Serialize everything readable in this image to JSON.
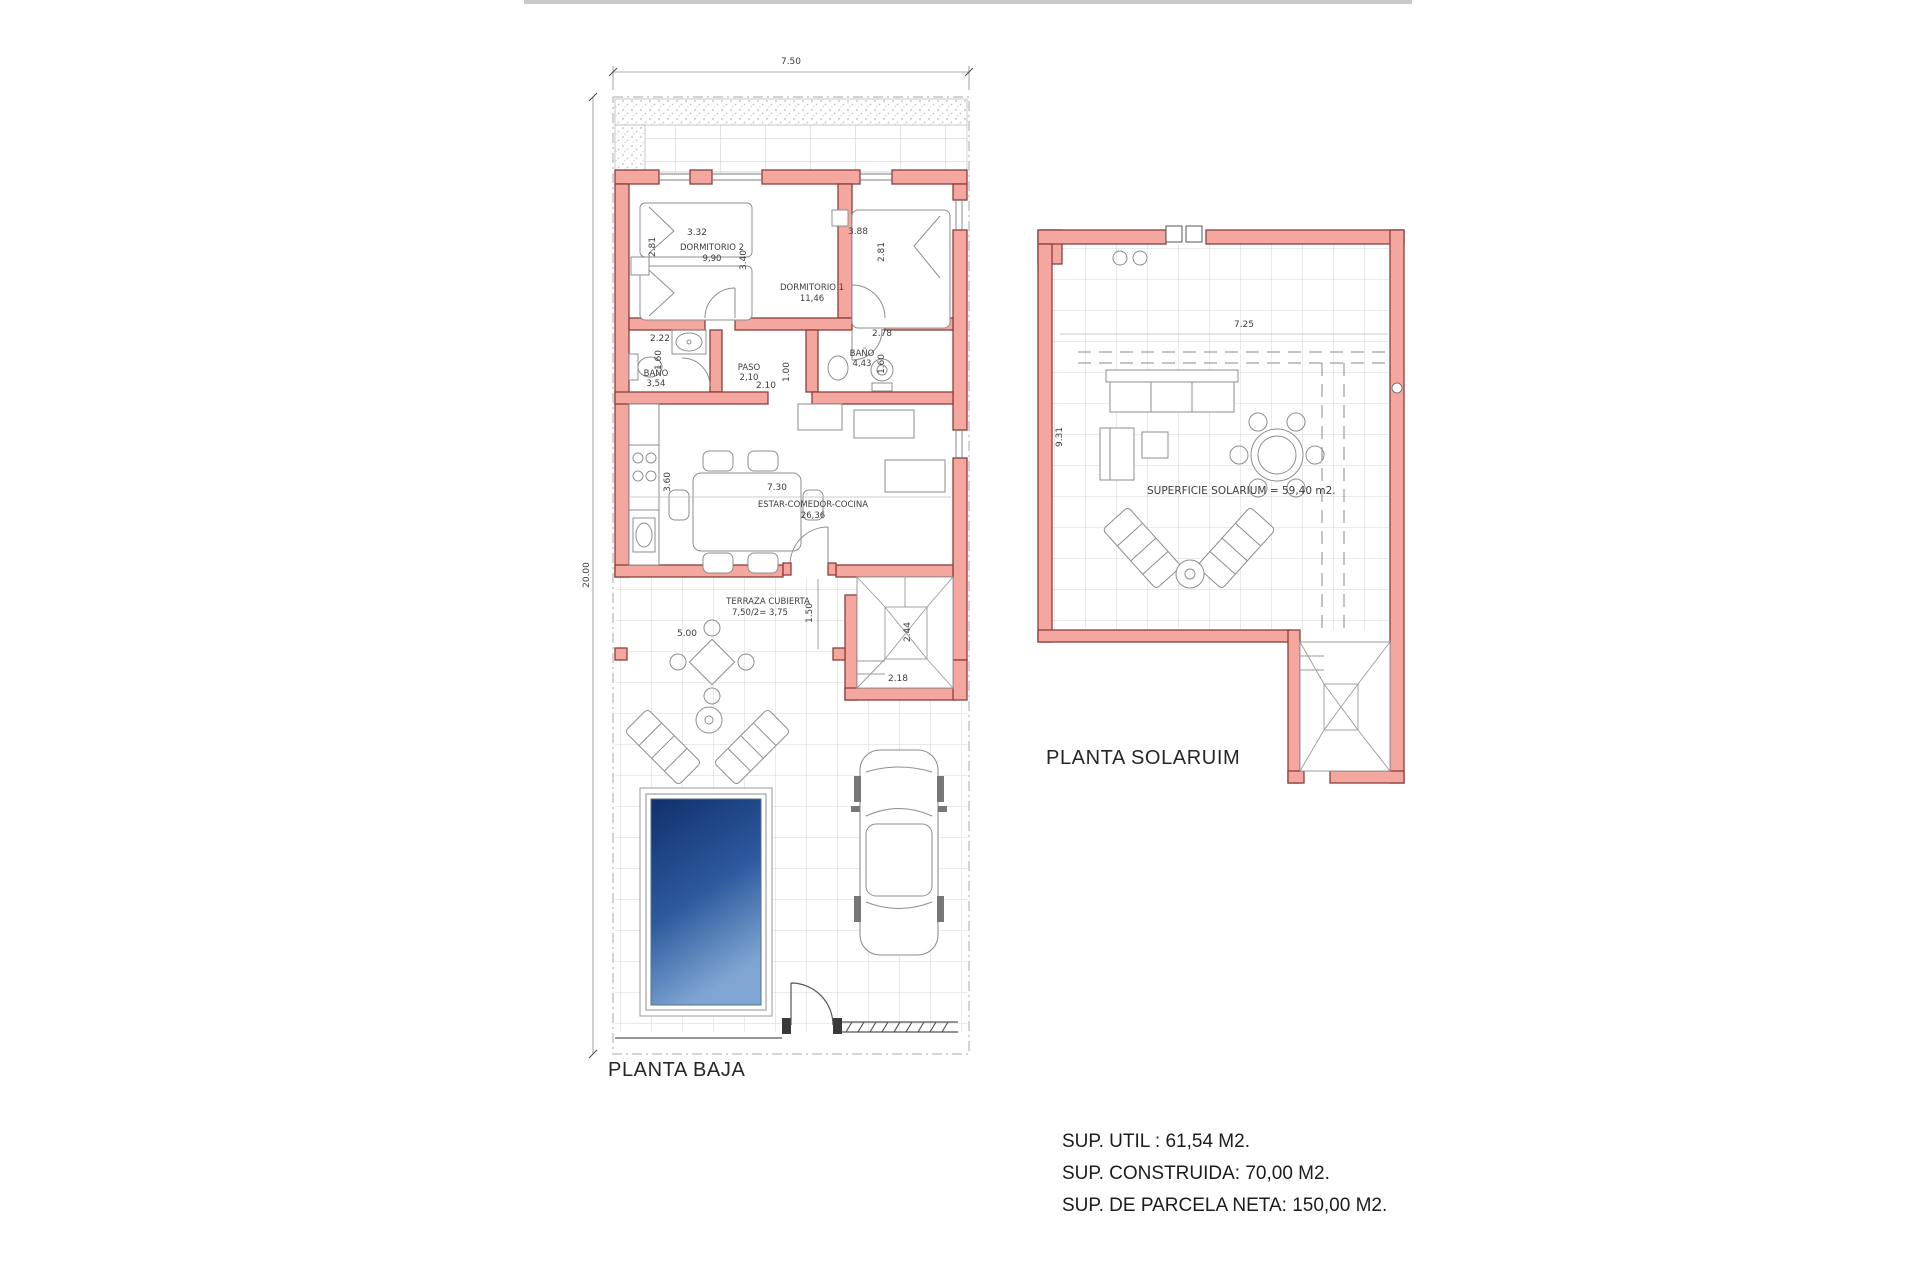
{
  "planta_baja": {
    "title": "PLANTA BAJA",
    "total_width": "7.50",
    "total_height": "20.00",
    "dorm2": {
      "name": "DORMITORIO 2",
      "area": "9,90",
      "dim_w": "3.32",
      "dim_h": "2.81",
      "dim_h2": "3.40"
    },
    "dorm1": {
      "name": "DORMITORIO 1",
      "area": "11,46",
      "dim_w": "3.88",
      "dim_h": "2.81"
    },
    "bano1": {
      "name": "BAÑO",
      "area": "3,54",
      "dim_w": "2.22",
      "dim_h": "1.60"
    },
    "paso": {
      "name": "PASO",
      "area": "2,10",
      "dim_w": "2.10",
      "dim_h": "1.00"
    },
    "bano2": {
      "name": "BAÑO",
      "area": "4,43",
      "dim_w": "2.78",
      "dim_h": "1.60"
    },
    "estar": {
      "name": "ESTAR-COMEDOR-COCINA",
      "area": "26,36",
      "dim_w": "7.30",
      "dim_h": "3.60"
    },
    "terraza": {
      "name": "TERRAZA CUBIERTA",
      "area": "7,50/2= 3,75",
      "dim_w": "5.00",
      "dim_h": "1.50"
    },
    "escalera": {
      "dim_h": "2.44",
      "dim_w": "2.18"
    }
  },
  "planta_solarium": {
    "title": "PLANTA SOLARUIM",
    "surface_label": "SUPERFICIE SOLARIUM = 59,40 m2.",
    "dim_w": "7.25",
    "dim_h": "9.31"
  },
  "summary": {
    "util": "SUP. UTIL : 61,54 M2.",
    "construida": "SUP. CONSTRUIDA: 70,00 M2.",
    "parcela": "SUP. DE PARCELA NETA: 150,00 M2."
  },
  "colors": {
    "wall_fill": "#F3A79F",
    "wall_stroke": "#8C3F3B",
    "pool_dark": "#10306b",
    "pool_light": "#7fa6d2",
    "top_rule": "#c9c9c9"
  }
}
